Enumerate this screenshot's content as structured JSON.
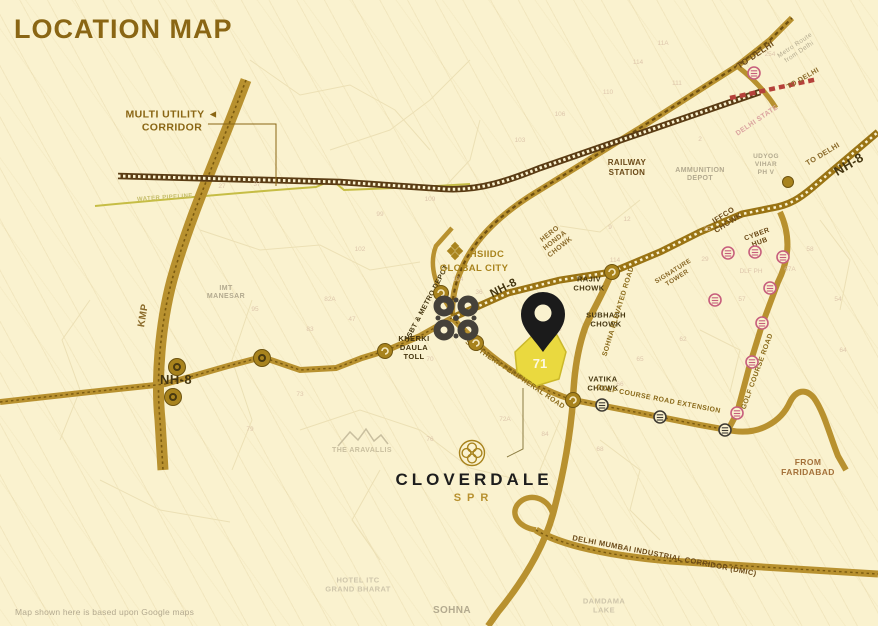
{
  "title": "LOCATION MAP",
  "disclaimer": "Map shown here is based upon Google maps",
  "brand": {
    "name": "CLOVERDALE",
    "sub": "SPR"
  },
  "plot": {
    "number": "71"
  },
  "colors": {
    "background": "#faf2cf",
    "road_gold": "#b8912f",
    "road_dark": "#6e4f10",
    "railway": "#5a3c14",
    "plot_yellow": "#ead93f",
    "pin_black": "#1b1b1b",
    "metro_pink": "#c75f7d",
    "title_gold": "#8a6614",
    "state_border_red": "#b5413a"
  },
  "map": {
    "labels": [
      {
        "id": "multi-utility-corridor",
        "text": "MULTI UTILITY ◄\nCORRIDOR",
        "x": 172,
        "y": 124,
        "rot": 0,
        "cls": "title-gold",
        "size": 10.5,
        "bold": true
      },
      {
        "id": "kmp",
        "text": "KMP",
        "x": 146,
        "y": 316,
        "rot": -80,
        "cls": "brown",
        "size": 10,
        "bold": true
      },
      {
        "id": "imt-manesar",
        "text": "IMT\nMANESAR",
        "x": 226,
        "y": 294,
        "rot": 0,
        "cls": "gray",
        "size": 7,
        "bold": true
      },
      {
        "id": "nh8-west",
        "text": "NH-8",
        "x": 176,
        "y": 384,
        "rot": 0,
        "cls": "dark",
        "size": 13,
        "bold": true
      },
      {
        "id": "kherki-daula-toll",
        "text": "KHERKI\nDAULA\nTOLL",
        "x": 414,
        "y": 350,
        "rot": 0,
        "cls": "dark",
        "size": 7.5,
        "bold": true
      },
      {
        "id": "isbt-metro-depot",
        "text": "ISBT & METRO DEPOT",
        "x": 429,
        "y": 303,
        "rot": -62,
        "cls": "dark",
        "size": 7,
        "bold": true
      },
      {
        "id": "hsiidc",
        "text": "HSIIDC",
        "x": 487,
        "y": 257,
        "rot": 0,
        "cls": "gold",
        "size": 9.5,
        "bold": true
      },
      {
        "id": "global-city",
        "text": "GLOBAL CITY",
        "x": 474,
        "y": 271,
        "rot": 0,
        "cls": "gold",
        "size": 9.5,
        "bold": true
      },
      {
        "id": "nh8-mid",
        "text": "NH-8",
        "x": 505,
        "y": 291,
        "rot": -27,
        "cls": "dark",
        "size": 11.5,
        "bold": true
      },
      {
        "id": "hero-honda-chowk",
        "text": "HERO\nHONDA\nCHOWK",
        "x": 556,
        "y": 242,
        "rot": -38,
        "cls": "brown",
        "size": 7,
        "bold": true
      },
      {
        "id": "rajiv-chowk",
        "text": "RAJIV\nCHOWK",
        "x": 589,
        "y": 286,
        "rot": 0,
        "cls": "dark",
        "size": 7.5,
        "bold": true
      },
      {
        "id": "subhash-chowk",
        "text": "SUBHASH\nCHOWK",
        "x": 606,
        "y": 322,
        "rot": 0,
        "cls": "dark",
        "size": 7.5,
        "bold": true
      },
      {
        "id": "sohna-elevated-road",
        "text": "SOHNA ELEVATED ROAD",
        "x": 620,
        "y": 312,
        "rot": -73,
        "cls": "road",
        "size": 7,
        "bold": true
      },
      {
        "id": "vatika-chowk",
        "text": "VATIKA\nCHOWK",
        "x": 603,
        "y": 386,
        "rot": 0,
        "cls": "dark",
        "size": 7.5,
        "bold": true
      },
      {
        "id": "southern-peripheral-road",
        "text": "SOUTHERN PERIPHERAL ROAD",
        "x": 514,
        "y": 376,
        "rot": 34,
        "cls": "road",
        "size": 7,
        "bold": true
      },
      {
        "id": "golf-course-road-extension",
        "text": "GOLF COURSE ROAD EXTENSION",
        "x": 658,
        "y": 401,
        "rot": 11,
        "cls": "road",
        "size": 7,
        "bold": true
      },
      {
        "id": "golf-course-road",
        "text": "GOLF COURSE ROAD",
        "x": 759,
        "y": 372,
        "rot": -70,
        "cls": "road",
        "size": 7,
        "bold": true
      },
      {
        "id": "from-faridabad",
        "text": "FROM\nFARIDABAD",
        "x": 808,
        "y": 470,
        "rot": 0,
        "cls": "brownred",
        "size": 8.5,
        "bold": true
      },
      {
        "id": "dmic",
        "text": "DELHI MUMBAI INDUSTRIAL CORRIDOR (DMIC)",
        "x": 664,
        "y": 558,
        "rot": 11,
        "cls": "darkbrown",
        "size": 7.5,
        "bold": true
      },
      {
        "id": "sohna",
        "text": "SOHNA",
        "x": 452,
        "y": 613,
        "rot": 0,
        "cls": "gray",
        "size": 10,
        "bold": true
      },
      {
        "id": "damdama-lake",
        "text": "DAMDAMA\nLAKE",
        "x": 604,
        "y": 608,
        "rot": 0,
        "cls": "lightgray",
        "size": 7.5,
        "bold": true
      },
      {
        "id": "hotel-itc-grand-bharat",
        "text": "HOTEL ITC\nGRAND BHARAT",
        "x": 358,
        "y": 587,
        "rot": 0,
        "cls": "lightgray",
        "size": 7.5,
        "bold": true
      },
      {
        "id": "the-aravallis",
        "text": "THE ARAVALLIS",
        "x": 362,
        "y": 452,
        "rot": 0,
        "cls": "lightgold",
        "size": 7,
        "bold": true
      },
      {
        "id": "railway-station",
        "text": "RAILWAY\nSTATION",
        "x": 627,
        "y": 170,
        "rot": 0,
        "cls": "darkbrown",
        "size": 8,
        "bold": true
      },
      {
        "id": "to-delhi-metro-road",
        "text": "TO DELHI",
        "x": 757,
        "y": 57,
        "rot": -34,
        "cls": "darkbrown",
        "size": 8.5,
        "bold": true
      },
      {
        "id": "metro-route-note",
        "text": "Metro Route\nfrom Delhi",
        "x": 798,
        "y": 50,
        "rot": -34,
        "cls": "gray",
        "size": 6.5,
        "bold": false
      },
      {
        "id": "to-delhi-railway",
        "text": "TO DELHI",
        "x": 804,
        "y": 80,
        "rot": -30,
        "cls": "brown",
        "size": 7,
        "bold": true
      },
      {
        "id": "delhi-state",
        "text": "DELHI STATE",
        "x": 758,
        "y": 122,
        "rot": -34,
        "cls": "pink",
        "size": 7,
        "bold": true
      },
      {
        "id": "ammunition-depot",
        "text": "AMMUNITION\nDEPOT",
        "x": 700,
        "y": 176,
        "rot": 0,
        "cls": "gray",
        "size": 7,
        "bold": true
      },
      {
        "id": "udyog-vihar-ph-v",
        "text": "UDYOG\nVIHAR\nPH V",
        "x": 766,
        "y": 166,
        "rot": 0,
        "cls": "gray",
        "size": 6.5,
        "bold": true
      },
      {
        "id": "iffco-chowk",
        "text": "IFFCO\nCHOWK",
        "x": 727,
        "y": 221,
        "rot": -32,
        "cls": "darkbrown",
        "size": 7.5,
        "bold": true
      },
      {
        "id": "cyber-hub",
        "text": "CYBER\nHUB",
        "x": 759,
        "y": 240,
        "rot": -20,
        "cls": "darkbrown",
        "size": 7,
        "bold": true
      },
      {
        "id": "signature-tower",
        "text": "SIGNATURE\nTOWER",
        "x": 676,
        "y": 276,
        "rot": -32,
        "cls": "brown",
        "size": 6.5,
        "bold": true
      },
      {
        "id": "to-delhi-nh8",
        "text": "TO DELHI",
        "x": 824,
        "y": 156,
        "rot": -31,
        "cls": "brown",
        "size": 7.5,
        "bold": true
      },
      {
        "id": "nh8-top-right",
        "text": "NH-8",
        "x": 851,
        "y": 168,
        "rot": -31,
        "cls": "dark",
        "size": 13,
        "bold": true
      },
      {
        "id": "water-pipeline",
        "text": "WATER PIPELINE",
        "x": 165,
        "y": 199,
        "rot": -4,
        "cls": "olive",
        "size": 6,
        "bold": true
      }
    ],
    "plot_numbers": [
      {
        "t": "11A",
        "x": 663,
        "y": 45
      },
      {
        "t": "114",
        "x": 638,
        "y": 64
      },
      {
        "t": "111",
        "x": 677,
        "y": 85
      },
      {
        "t": "110",
        "x": 608,
        "y": 94
      },
      {
        "t": "106",
        "x": 560,
        "y": 116
      },
      {
        "t": "103",
        "x": 520,
        "y": 142
      },
      {
        "t": "37",
        "x": 257,
        "y": 186
      },
      {
        "t": "27",
        "x": 222,
        "y": 188
      },
      {
        "t": "104",
        "x": 458,
        "y": 281
      },
      {
        "t": "36",
        "x": 479,
        "y": 294
      },
      {
        "t": "9",
        "x": 610,
        "y": 229
      },
      {
        "t": "12",
        "x": 627,
        "y": 221
      },
      {
        "t": "114",
        "x": 615,
        "y": 262
      },
      {
        "t": "25",
        "x": 707,
        "y": 231
      },
      {
        "t": "29",
        "x": 705,
        "y": 261
      },
      {
        "t": "DLF PH",
        "x": 751,
        "y": 273
      },
      {
        "t": "57",
        "x": 742,
        "y": 301
      },
      {
        "t": "62",
        "x": 683,
        "y": 341
      },
      {
        "t": "65",
        "x": 640,
        "y": 361
      },
      {
        "t": "66",
        "x": 620,
        "y": 386
      },
      {
        "t": "63",
        "x": 663,
        "y": 421
      },
      {
        "t": "64",
        "x": 843,
        "y": 352
      },
      {
        "t": "47",
        "x": 352,
        "y": 321
      },
      {
        "t": "75",
        "x": 558,
        "y": 331
      },
      {
        "t": "70",
        "x": 430,
        "y": 361
      },
      {
        "t": "73",
        "x": 300,
        "y": 396
      },
      {
        "t": "79",
        "x": 250,
        "y": 431
      },
      {
        "t": "82A",
        "x": 330,
        "y": 301
      },
      {
        "t": "83",
        "x": 310,
        "y": 331
      },
      {
        "t": "84",
        "x": 545,
        "y": 436
      },
      {
        "t": "68",
        "x": 600,
        "y": 451
      },
      {
        "t": "72A",
        "x": 505,
        "y": 421
      },
      {
        "t": "76",
        "x": 430,
        "y": 441
      },
      {
        "t": "95",
        "x": 255,
        "y": 311
      },
      {
        "t": "102",
        "x": 360,
        "y": 251
      },
      {
        "t": "109",
        "x": 430,
        "y": 201
      },
      {
        "t": "99",
        "x": 380,
        "y": 216
      },
      {
        "t": "254",
        "x": 770,
        "y": 56
      },
      {
        "t": "58",
        "x": 810,
        "y": 251
      },
      {
        "t": "67A",
        "x": 790,
        "y": 271
      },
      {
        "t": "54",
        "x": 838,
        "y": 301
      },
      {
        "t": "2",
        "x": 700,
        "y": 141
      }
    ],
    "icons": {
      "metro_stations_pink": [
        [
          754,
          73
        ],
        [
          728,
          253
        ],
        [
          755,
          252
        ],
        [
          783,
          257
        ],
        [
          715,
          300
        ],
        [
          770,
          288
        ],
        [
          762,
          323
        ],
        [
          752,
          362
        ],
        [
          737,
          413
        ]
      ],
      "metro_stations_dark": [
        [
          602,
          405
        ],
        [
          660,
          417
        ],
        [
          725,
          430
        ]
      ],
      "junctions": [
        [
          612,
          272
        ],
        [
          441,
          293
        ],
        [
          476,
          343
        ],
        [
          573,
          400
        ],
        [
          385,
          351
        ]
      ],
      "landmark_dots": [
        [
          177,
          367
        ],
        [
          173,
          397
        ],
        [
          262,
          358
        ]
      ],
      "small_dots": [
        [
          788,
          182
        ]
      ]
    }
  }
}
